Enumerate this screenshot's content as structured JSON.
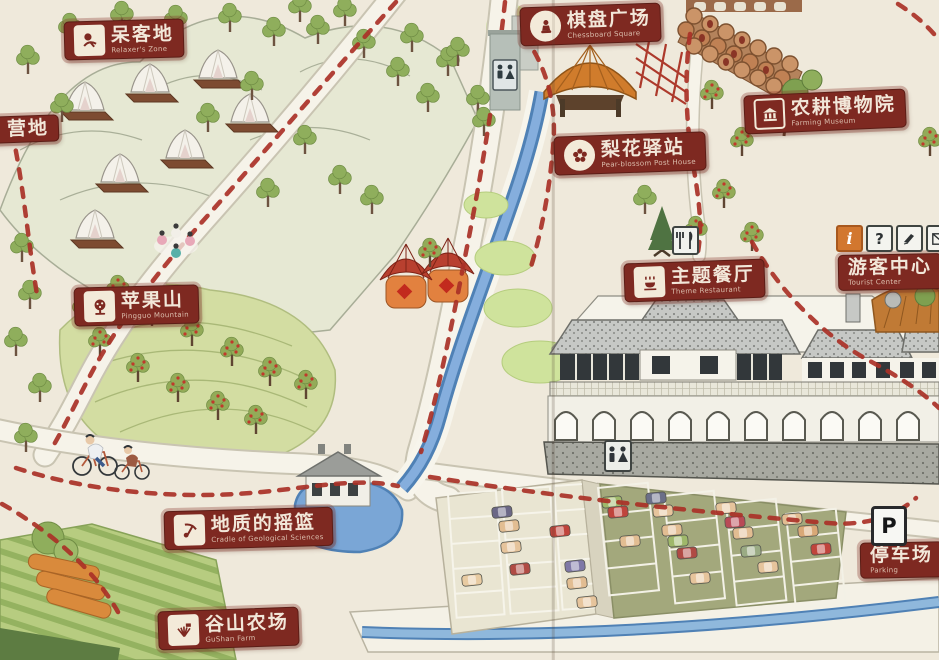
{
  "map_name": "hand-drawn scenic area tourist map",
  "labels": [
    {
      "id": "relaxer-zone",
      "zh": "呆客地",
      "en": "Relaxer's Zone",
      "icon": "person-icon"
    },
    {
      "id": "campsite",
      "zh": "营地",
      "en": "",
      "icon": ""
    },
    {
      "id": "chessboard-square",
      "zh": "棋盘广场",
      "en": "Chessboard Square",
      "icon": "chess-icon"
    },
    {
      "id": "pear-blossom-post",
      "zh": "梨花驿站",
      "en": "Pear-blossom Post House",
      "icon": "flower-icon"
    },
    {
      "id": "farming-museum",
      "zh": "农耕博物院",
      "en": "Farming Museum",
      "icon": "museum-icon"
    },
    {
      "id": "pingguo-mountain",
      "zh": "苹果山",
      "en": "Pingguo Mountain",
      "icon": "apple-tree-icon"
    },
    {
      "id": "theme-restaurant",
      "zh": "主题餐厅",
      "en": "Theme Restaurant",
      "icon": "bowl-icon"
    },
    {
      "id": "tourist-center",
      "zh": "游客中心",
      "en": "Tourist Center",
      "icon": ""
    },
    {
      "id": "geological-cradle",
      "zh": "地质的摇篮",
      "en": "Cradle of Geological Sciences",
      "icon": "pickaxe-icon"
    },
    {
      "id": "gushan-farm",
      "zh": "谷山农场",
      "en": "GuShan Farm",
      "icon": "barn-icon"
    },
    {
      "id": "parking",
      "zh": "停车场",
      "en": "Parking",
      "icon": "parking-sign"
    }
  ],
  "signs": {
    "parking": "P",
    "info": "i",
    "help": "?"
  },
  "icons": [
    "restroom-icon",
    "fork-knife-icon",
    "info-icon",
    "question-icon",
    "pen-icon",
    "mail-icon",
    "parking-sign"
  ],
  "palette": {
    "plaque_red": "#7e2921",
    "trail_red": "#aa3127",
    "river_blue": "#6f9fd2",
    "hill_green": "#ccd79b",
    "paper": "#efe9db",
    "roof_grey": "#c6c8c5",
    "parking_olive": "#a3a87c",
    "thatch_orange": "#d07c2c"
  }
}
